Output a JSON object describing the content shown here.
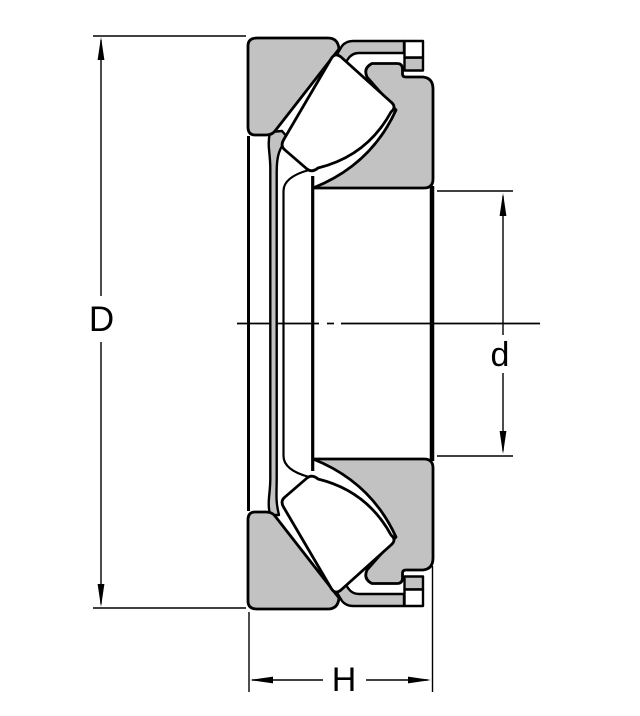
{
  "drawing": {
    "type": "technical-drawing",
    "subject": "spherical-roller-thrust-bearing-cross-section",
    "labels": {
      "outer_diameter": "D",
      "bore_diameter": "d",
      "height": "H"
    },
    "colors": {
      "section_fill": "#c2c2c2",
      "roller_fill": "#ffffff",
      "line": "#000000",
      "background": "#ffffff"
    }
  }
}
